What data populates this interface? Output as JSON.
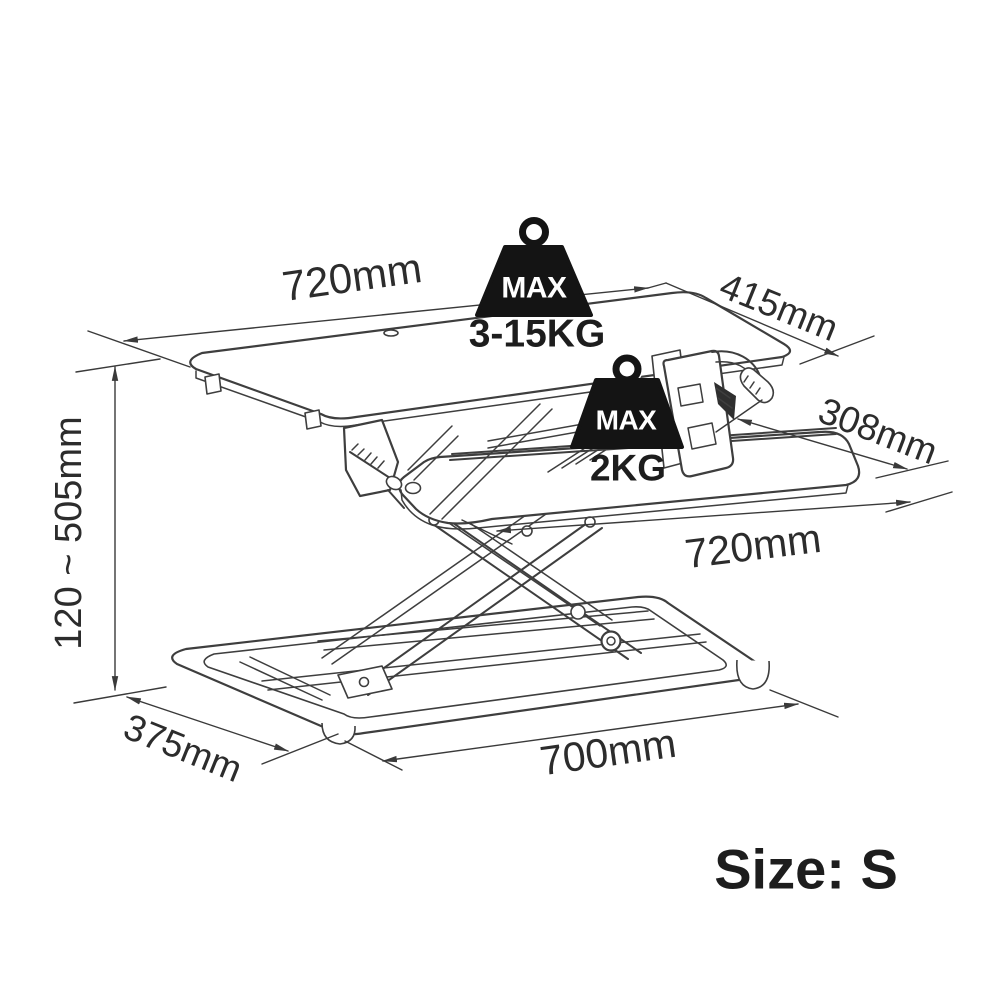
{
  "diagram": {
    "subject": "sit-stand desk riser technical drawing",
    "dimensions": {
      "desktop_width": "720mm",
      "desktop_depth": "415mm",
      "tray_depth": "308mm",
      "tray_width": "720mm",
      "height_range": "120 ~ 505mm",
      "base_depth": "375mm",
      "base_width": "700mm"
    },
    "load_ratings": {
      "desktop": {
        "badge": "MAX",
        "capacity": "3-15KG"
      },
      "tray": {
        "badge": "MAX",
        "capacity": "2KG"
      }
    },
    "size_label": "Size: S",
    "colors": {
      "line_art": "#3e3e3e",
      "text": "#2c2c2c",
      "weight_icon_fill": "#141414",
      "background": "#ffffff"
    }
  }
}
